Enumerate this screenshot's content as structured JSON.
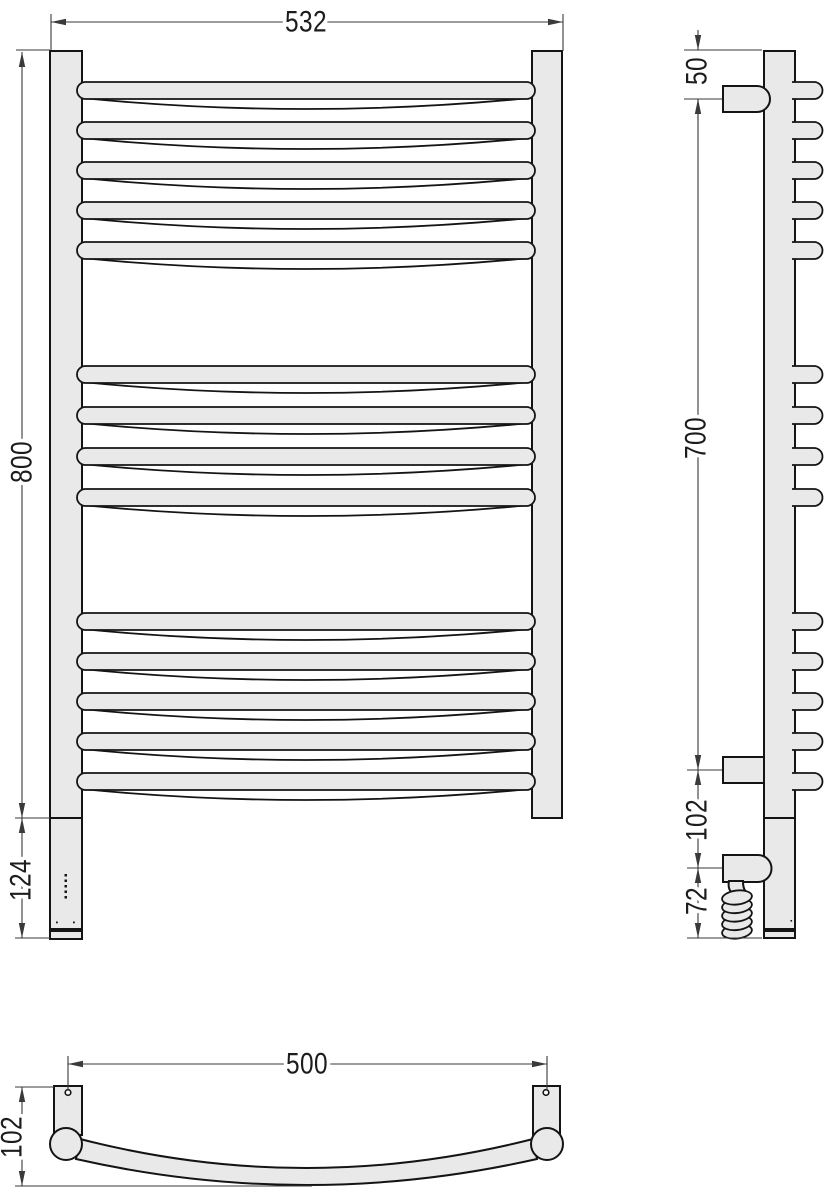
{
  "drawing": {
    "front": {
      "width": "532",
      "height": "800",
      "control_box": "124"
    },
    "side": {
      "top_offset": "50",
      "bracket_span": "700",
      "lower_offset": "102",
      "cable_offset": "72"
    },
    "plan": {
      "mount_width": "500",
      "depth": "102"
    }
  },
  "colors": {
    "background": "#ffffff",
    "fill": "#e9e9e9",
    "outline": "#141414",
    "dimension": "#3a3a3a"
  }
}
